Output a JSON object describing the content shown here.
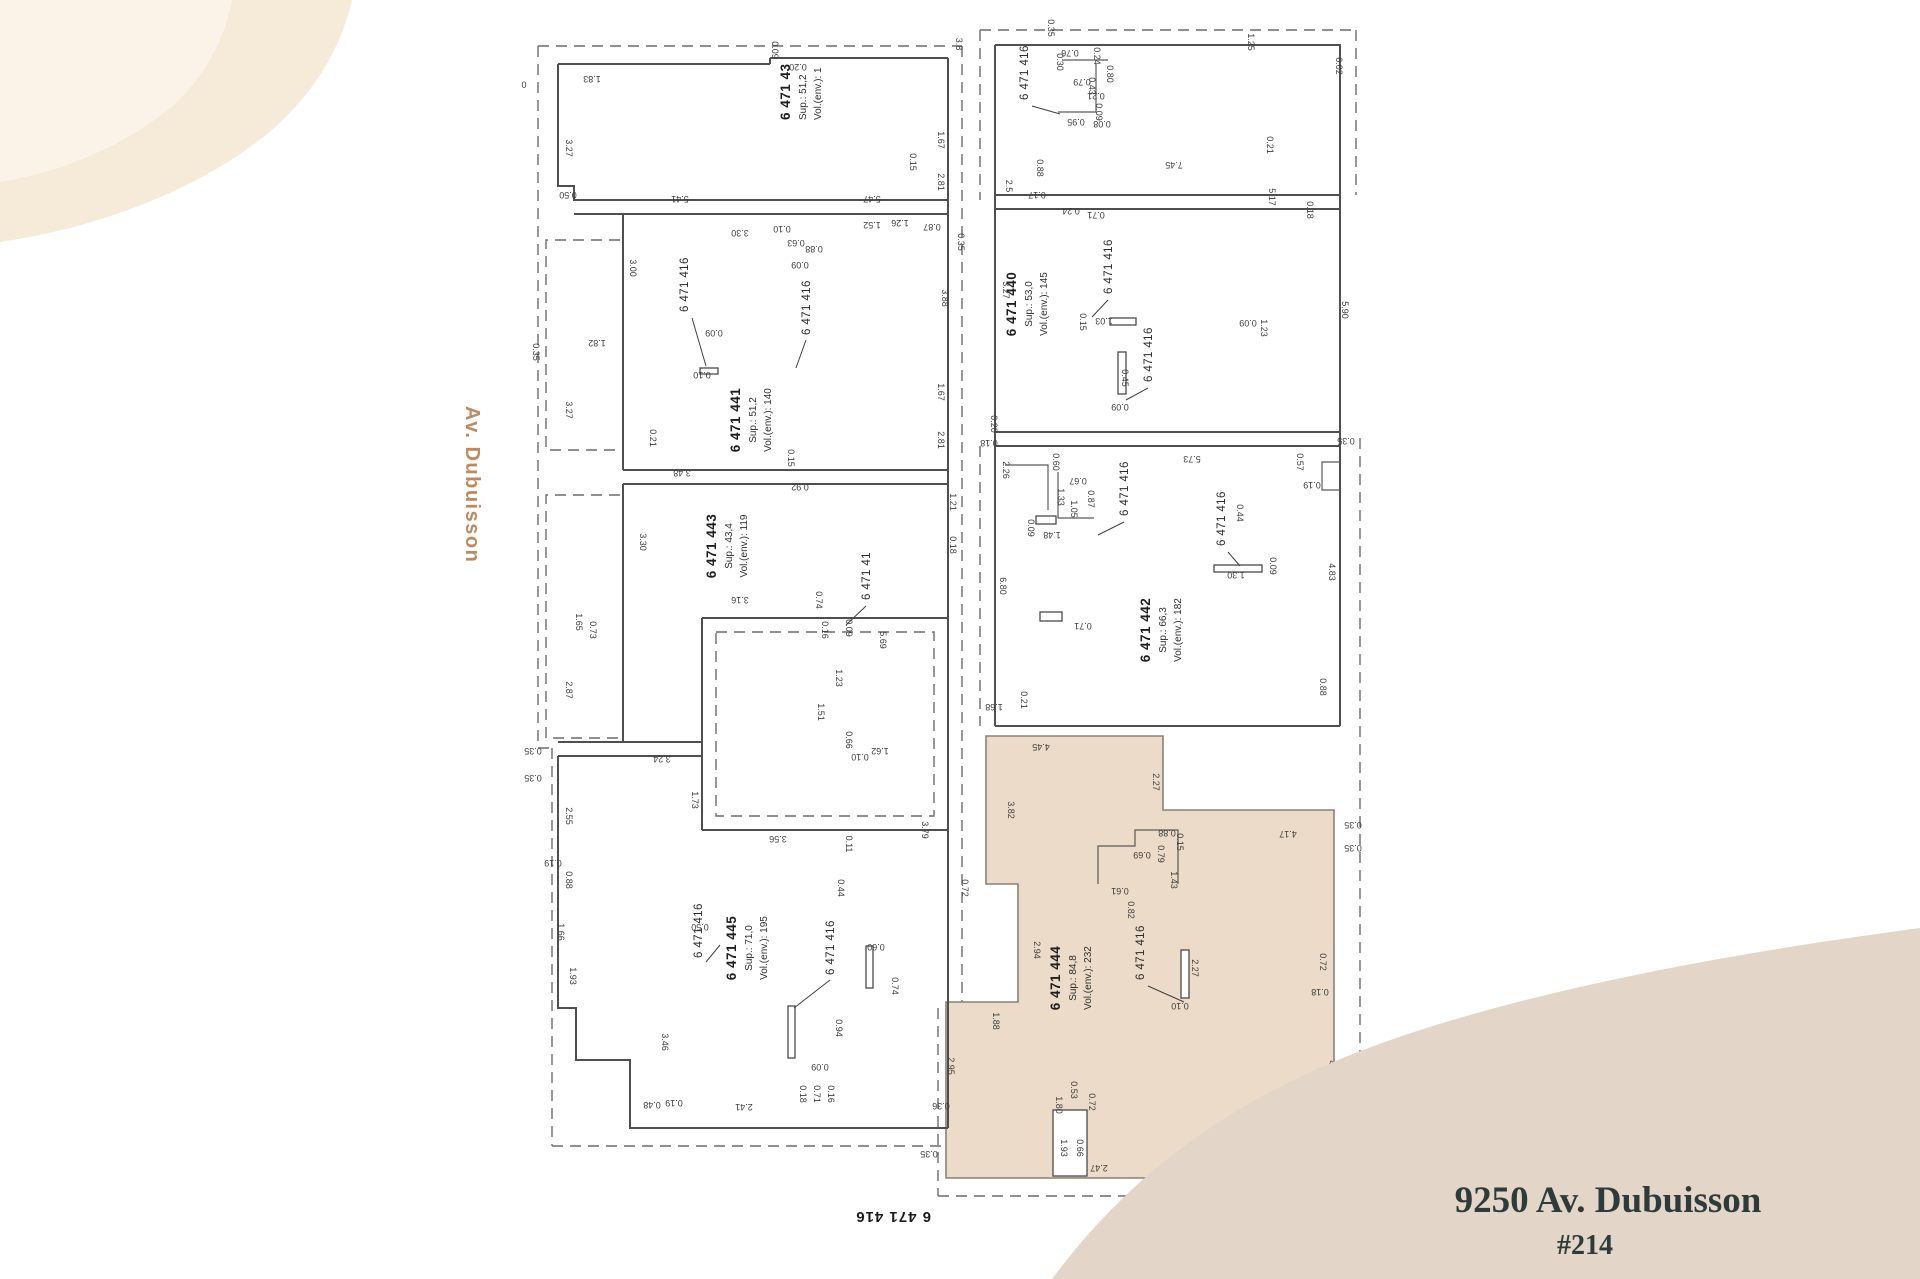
{
  "street_label": {
    "text": "Av. Dubuisson",
    "color": "#bf8a5f"
  },
  "address_card": {
    "line1": "9250 Av. Dubuisson",
    "unit": "#214",
    "text_color": "#2d3c3b",
    "bg_color": "#e3d5c7"
  },
  "decor": {
    "top_left_blob_outer": "#f6ead9",
    "top_left_blob_inner": "#fbf3e7",
    "swoosh_fill": "#e3d5c7"
  },
  "plan": {
    "line_color": "#4f4f4f",
    "highlight_fill": "#ebdbc8",
    "bottom_lot_label": "6 471 416",
    "units": [
      {
        "lot": "6 471 43",
        "sup": "Sup.: 51,2",
        "vol": "Vol.(env.): 1"
      },
      {
        "lot": "6 471 441",
        "sup": "Sup.: 51,2",
        "vol": "Vol.(env.): 140"
      },
      {
        "lot": "6 471 443",
        "sup": "Sup.: 43,4",
        "vol": "Vol.(env.): 119"
      },
      {
        "lot": "6 471 445",
        "sup": "Sup.: 71,0",
        "vol": "Vol.(env.): 195"
      },
      {
        "lot": "6 471 440",
        "sup": "Sup.: 53,0",
        "vol": "Vol.(env.): 145"
      },
      {
        "lot": "6 471 442",
        "sup": "Sup.: 66,3",
        "vol": "Vol.(env.): 182"
      },
      {
        "lot": "6 471 444",
        "sup": "Sup.: 84,8",
        "vol": "Vol.(env.): 232"
      }
    ],
    "ref_labels": [
      [
        "6 471 416",
        688,
        312
      ],
      [
        "6 471 416",
        810,
        335
      ],
      [
        "6 471 41",
        870,
        600
      ],
      [
        "6 471 416",
        702,
        958
      ],
      [
        "6 471 416",
        834,
        975
      ],
      [
        "6 471 416",
        1028,
        100
      ],
      [
        "6 471 416",
        1112,
        294
      ],
      [
        "6 471 416",
        1152,
        382
      ],
      [
        "6 471 416",
        1128,
        516
      ],
      [
        "6 471 416",
        1225,
        546
      ],
      [
        "6 471 416",
        1144,
        980
      ]
    ],
    "dimensions": [
      [
        "0",
        524,
        88,
        0
      ],
      [
        "1.83",
        592,
        76,
        180
      ],
      [
        "3.27",
        566,
        148,
        90
      ],
      [
        "0.50",
        568,
        192,
        180
      ],
      [
        "5.41",
        680,
        196,
        180
      ],
      [
        "5.47",
        872,
        196,
        180
      ],
      [
        "0.20",
        798,
        64,
        180
      ],
      [
        "0.09",
        772,
        50,
        90
      ],
      [
        "3.8",
        956,
        44,
        90
      ],
      [
        "1.67",
        938,
        140,
        90
      ],
      [
        "2.81",
        938,
        182,
        90
      ],
      [
        "0.15",
        910,
        162,
        90
      ],
      [
        "1.26",
        900,
        220,
        180
      ],
      [
        "1.52",
        872,
        222,
        180
      ],
      [
        "0.87",
        932,
        224,
        180
      ],
      [
        "0.35",
        958,
        242,
        90
      ],
      [
        "3.30",
        740,
        230,
        180
      ],
      [
        "0.10",
        782,
        226,
        180
      ],
      [
        "0.63",
        796,
        240,
        180
      ],
      [
        "0.88",
        814,
        246,
        180
      ],
      [
        "0.09",
        800,
        262,
        180
      ],
      [
        "3.00",
        630,
        268,
        90
      ],
      [
        "1.82",
        597,
        340,
        180
      ],
      [
        "0.35",
        533,
        352,
        90
      ],
      [
        "3.27",
        566,
        410,
        90
      ],
      [
        "0.21",
        650,
        438,
        90
      ],
      [
        "3.48",
        682,
        470,
        180
      ],
      [
        "0.92",
        800,
        484,
        180
      ],
      [
        "0.15",
        788,
        458,
        90
      ],
      [
        "2.81",
        938,
        440,
        90
      ],
      [
        "1.67",
        938,
        392,
        90
      ],
      [
        "3.88",
        942,
        298,
        90
      ],
      [
        "0.09",
        714,
        330,
        180
      ],
      [
        "0.10",
        702,
        372,
        180
      ],
      [
        "3.30",
        640,
        542,
        90
      ],
      [
        "3.16",
        740,
        597,
        180
      ],
      [
        "0.74",
        816,
        600,
        90
      ],
      [
        "0.16",
        822,
        630,
        90
      ],
      [
        "0.09",
        846,
        628,
        90
      ],
      [
        "5.69",
        880,
        640,
        90
      ],
      [
        "1.23",
        836,
        678,
        90
      ],
      [
        "1.51",
        818,
        712,
        90
      ],
      [
        "0.66",
        846,
        740,
        90
      ],
      [
        "1.62",
        880,
        748,
        180
      ],
      [
        "0.10",
        860,
        754,
        180
      ],
      [
        "1.21",
        950,
        502,
        90
      ],
      [
        "0.18",
        950,
        545,
        90
      ],
      [
        "1.65",
        576,
        622,
        90
      ],
      [
        "0.73",
        590,
        630,
        90
      ],
      [
        "2.87",
        566,
        690,
        90
      ],
      [
        "0.35",
        533,
        748,
        180
      ],
      [
        "3.24",
        662,
        756,
        180
      ],
      [
        "0.35",
        533,
        775,
        180
      ],
      [
        "1.73",
        692,
        800,
        90
      ],
      [
        "3.56",
        778,
        836,
        180
      ],
      [
        "3.79",
        922,
        830,
        90
      ],
      [
        "0.11",
        846,
        844,
        90
      ],
      [
        "0.44",
        838,
        888,
        90
      ],
      [
        "2.55",
        566,
        816,
        90
      ],
      [
        "0.19",
        553,
        860,
        180
      ],
      [
        "0.88",
        566,
        880,
        90
      ],
      [
        "1.66",
        558,
        932,
        90
      ],
      [
        "1.93",
        570,
        976,
        90
      ],
      [
        "3.46",
        662,
        1042,
        90
      ],
      [
        "0.48",
        652,
        1102,
        180
      ],
      [
        "0.19",
        674,
        1100,
        180
      ],
      [
        "2.41",
        744,
        1104,
        180
      ],
      [
        "0.18",
        800,
        1094,
        90
      ],
      [
        "0.71",
        814,
        1094,
        90
      ],
      [
        "0.16",
        828,
        1094,
        90
      ],
      [
        "0.94",
        836,
        1028,
        90
      ],
      [
        "0.09",
        820,
        1064,
        180
      ],
      [
        "0.74",
        892,
        986,
        90
      ],
      [
        "0.60",
        876,
        944,
        180
      ],
      [
        "0.50",
        700,
        924,
        180
      ],
      [
        "0.35",
        1048,
        28,
        90
      ],
      [
        "0.76",
        1070,
        50,
        180
      ],
      [
        "0.24",
        1094,
        56,
        90
      ],
      [
        "0.30",
        1057,
        62,
        90
      ],
      [
        "0.79",
        1082,
        79,
        180
      ],
      [
        "0.43",
        1089,
        86,
        90
      ],
      [
        "0.80",
        1107,
        74,
        90
      ],
      [
        "0.21",
        1096,
        93,
        180
      ],
      [
        "0.95",
        1076,
        119,
        180
      ],
      [
        "0.09",
        1096,
        112,
        90
      ],
      [
        "0.08",
        1102,
        121,
        180
      ],
      [
        "1.25",
        1248,
        42,
        90
      ],
      [
        "6.02",
        1336,
        66,
        90
      ],
      [
        "0.21",
        1267,
        145,
        90
      ],
      [
        "7.45",
        1174,
        162,
        180
      ],
      [
        "0.88",
        1037,
        168,
        90
      ],
      [
        "0.17",
        1037,
        192,
        180
      ],
      [
        "2.5",
        1006,
        186,
        90
      ],
      [
        "5.17",
        1269,
        197,
        90
      ],
      [
        "0.24",
        1071,
        208,
        180
      ],
      [
        "0.71",
        1096,
        212,
        180
      ],
      [
        "0.18",
        1307,
        210,
        90
      ],
      [
        "3.27",
        1003,
        290,
        90
      ],
      [
        "1.03",
        1104,
        318,
        180
      ],
      [
        "0.15",
        1080,
        322,
        90
      ],
      [
        "0.45",
        1122,
        378,
        90
      ],
      [
        "0.09",
        1120,
        404,
        180
      ],
      [
        "1.23",
        1261,
        328,
        90
      ],
      [
        "0.09",
        1248,
        320,
        180
      ],
      [
        "5.90",
        1342,
        310,
        90
      ],
      [
        "0.20",
        991,
        424,
        90
      ],
      [
        "0.18",
        989,
        440,
        180
      ],
      [
        "5.73",
        1192,
        456,
        180
      ],
      [
        "0.35",
        1346,
        438,
        180
      ],
      [
        "2.26",
        1003,
        470,
        90
      ],
      [
        "0.60",
        1053,
        462,
        90
      ],
      [
        "0.67",
        1078,
        478,
        180
      ],
      [
        "1.33",
        1058,
        497,
        90
      ],
      [
        "1.05",
        1071,
        509,
        90
      ],
      [
        "0.87",
        1088,
        499,
        90
      ],
      [
        "1.48",
        1052,
        532,
        180
      ],
      [
        "0.09",
        1028,
        528,
        90
      ],
      [
        "6.80",
        1000,
        586,
        90
      ],
      [
        "0.71",
        1083,
        623,
        180
      ],
      [
        "1.30",
        1236,
        572,
        180
      ],
      [
        "0.09",
        1270,
        566,
        90
      ],
      [
        "0.44",
        1237,
        513,
        90
      ],
      [
        "4.83",
        1329,
        572,
        90
      ],
      [
        "0.57",
        1297,
        462,
        90
      ],
      [
        "0.19",
        1312,
        482,
        180
      ],
      [
        "0.88",
        1320,
        687,
        90
      ],
      [
        "1.68",
        994,
        704,
        180
      ],
      [
        "0.21",
        1021,
        700,
        90
      ],
      [
        "4.45",
        1041,
        744,
        180
      ],
      [
        "2.27",
        1153,
        782,
        90
      ],
      [
        "3.82",
        1008,
        810,
        90
      ],
      [
        "0.88",
        1167,
        830,
        180
      ],
      [
        "0.15",
        1177,
        842,
        90
      ],
      [
        "0.79",
        1158,
        854,
        90
      ],
      [
        "0.69",
        1142,
        852,
        180
      ],
      [
        "1.43",
        1171,
        880,
        90
      ],
      [
        "0.61",
        1120,
        888,
        180
      ],
      [
        "0.82",
        1128,
        910,
        90
      ],
      [
        "0.72",
        962,
        888,
        90
      ],
      [
        "2.94",
        1034,
        950,
        90
      ],
      [
        "1.88",
        993,
        1021,
        90
      ],
      [
        "4.17",
        1288,
        831,
        180
      ],
      [
        "0.72",
        1320,
        962,
        90
      ],
      [
        "0.18",
        1320,
        989,
        180
      ],
      [
        "2.27",
        1192,
        968,
        90
      ],
      [
        "0.10",
        1180,
        1003,
        180
      ],
      [
        "4.23",
        1329,
        1069,
        90
      ],
      [
        "2.95",
        948,
        1066,
        90
      ],
      [
        "0.36",
        941,
        1103,
        180
      ],
      [
        "1.80",
        1056,
        1105,
        90
      ],
      [
        "0.53",
        1071,
        1090,
        90
      ],
      [
        "0.72",
        1089,
        1102,
        90
      ],
      [
        "1.93",
        1061,
        1148,
        90
      ],
      [
        "0.66",
        1077,
        1148,
        90
      ],
      [
        "2.47",
        1099,
        1165,
        180
      ],
      [
        "4.54",
        1240,
        1167,
        180
      ],
      [
        "0.59",
        1306,
        1169,
        180
      ],
      [
        "0.35",
        929,
        1151,
        180
      ],
      [
        "0.35",
        1353,
        822,
        180
      ],
      [
        "0.35",
        1353,
        845,
        180
      ]
    ]
  }
}
